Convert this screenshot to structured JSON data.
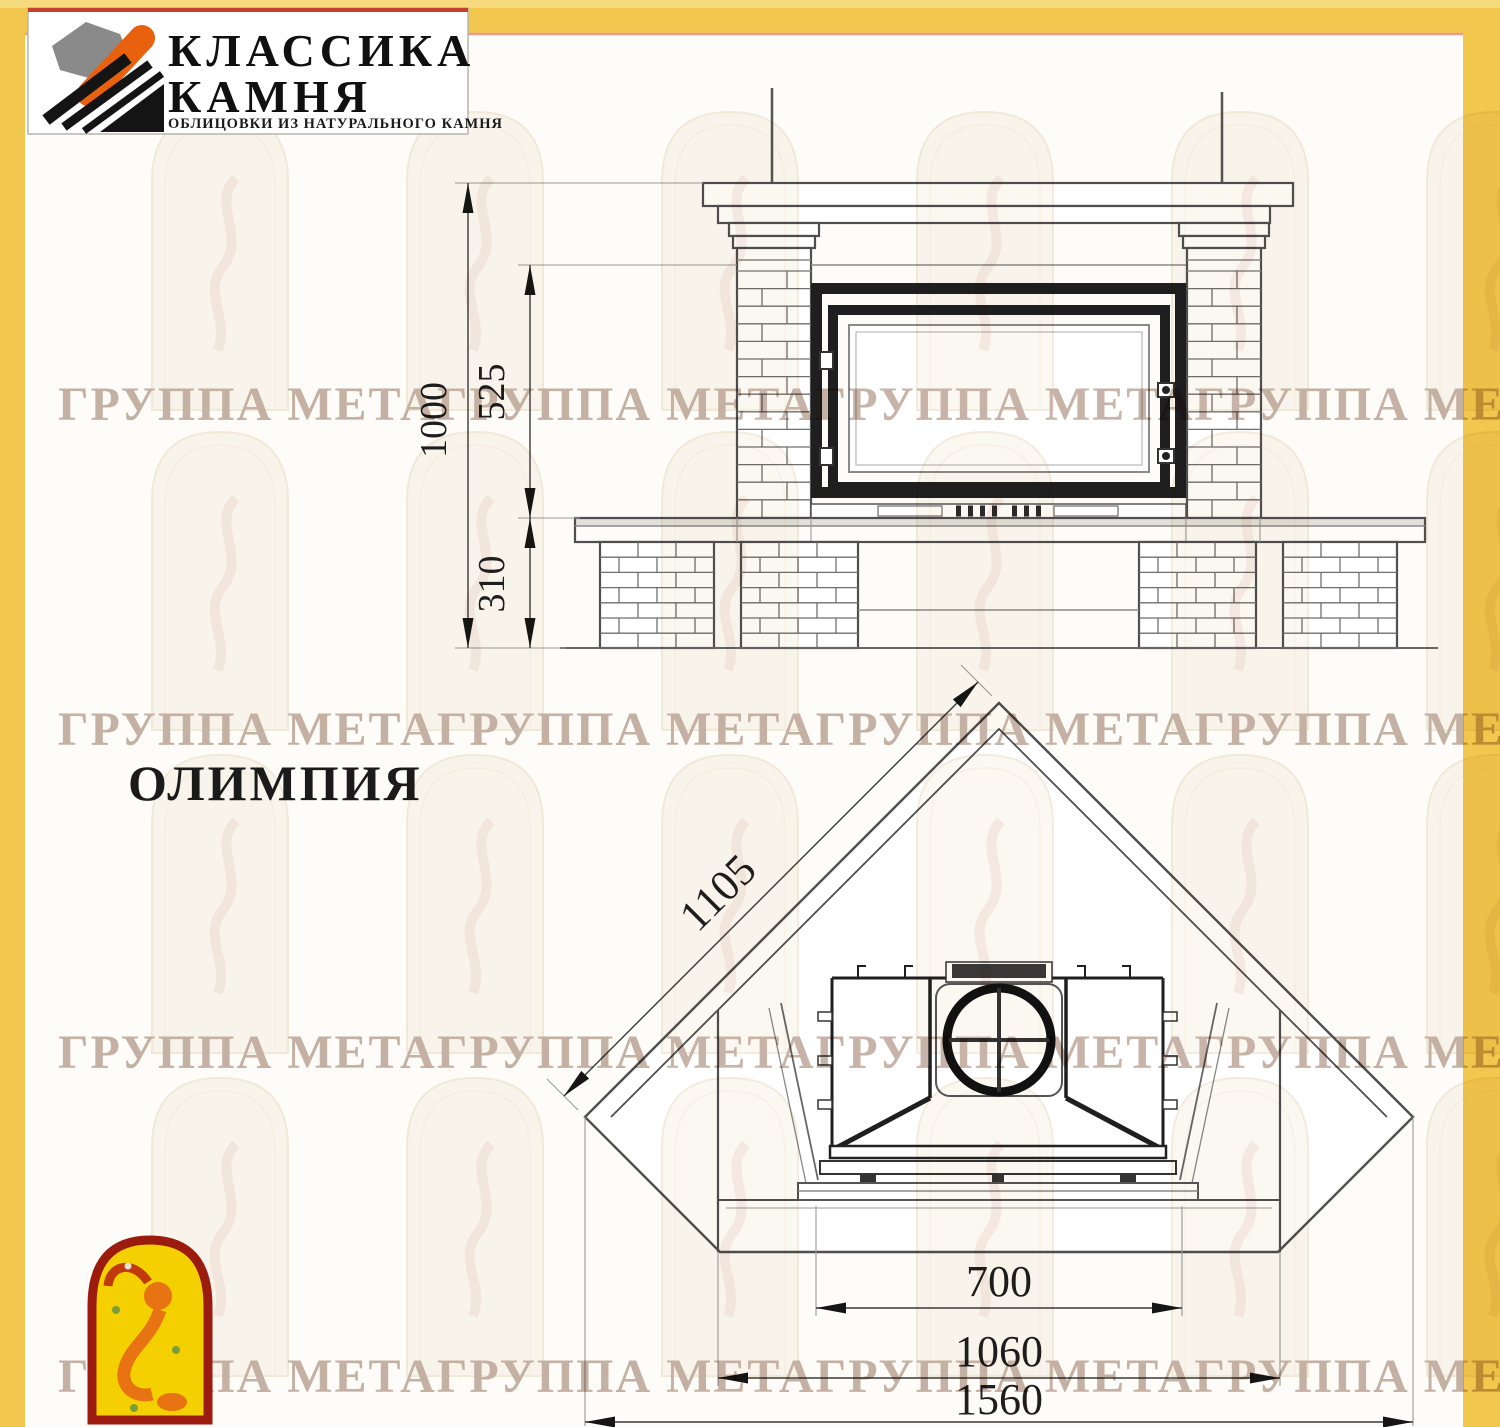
{
  "page": {
    "title_model": "ОЛИМПИЯ",
    "watermark_text": "ГРУППА МЕТАГРУППА МЕТАГРУППА МЕТАГРУППА МЕТА",
    "colors": {
      "border_yellow": "#F1C84D",
      "border_yellow_light": "#F6DA7E",
      "content_bg": "#FDFCF9",
      "accent_pink_line": "#E89C94",
      "logo_accent_red": "#C3402F",
      "logo_orange": "#E8610F",
      "logo_grey": "#8A8A8A",
      "logo_black": "#141414",
      "emblem_red": "#9B1B0E",
      "emblem_yellow": "#F4D000",
      "figure_orange": "#E87312",
      "figure_red": "#C23A0C"
    }
  },
  "logo": {
    "line1": "КЛАССИКА",
    "line2": "КАМНЯ",
    "subtitle": "ОБЛИЦОВКИ ИЗ НАТУРАЛЬНОГО КАМНЯ"
  },
  "front_view": {
    "dims": {
      "total_height": "1000",
      "opening_height": "525",
      "hearth_height": "310"
    }
  },
  "plan_view": {
    "dims": {
      "side_depth": "1105",
      "firebox_width": "700",
      "inner_width": "1060",
      "total_width": "1560"
    }
  }
}
